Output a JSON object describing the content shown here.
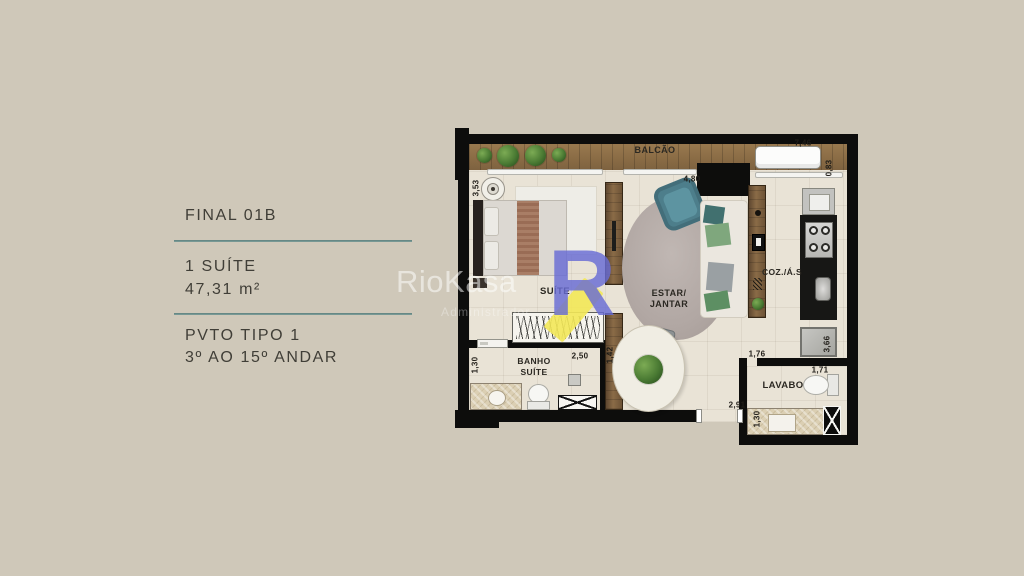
{
  "panel": {
    "title": "FINAL 01B",
    "unit_line1": "1 SUÍTE",
    "unit_line2": "47,31 m²",
    "floor_line1": "PVTO TIPO 1",
    "floor_line2": "3º AO 15º ANDAR"
  },
  "watermark": {
    "brand": "RioKasa",
    "subtitle": "Administrador",
    "logo_letter": "R",
    "logo_color": "#686bd4",
    "logo_accent": "#f3e858"
  },
  "plan": {
    "room_labels": {
      "balcony": "BALCÃO",
      "suite": "SUÍTE",
      "living_line1": "ESTAR/",
      "living_line2": "JANTAR",
      "bathroom_line1": "BANHO",
      "bathroom_line2": "SUÍTE",
      "kitchen": "COZ./Á.S",
      "halfbath": "LAVABO"
    },
    "dimensions": {
      "balcony_width": "7,46",
      "balcony_depth": "0,83",
      "suite_depth": "3,53",
      "living_width": "4,80",
      "bathroom_depth": "1,30",
      "bathroom_width": "2,50",
      "console_length": "1,42",
      "halfbath_top_width": "1,76",
      "halfbath_width": "1,71",
      "living_bottom_width": "2,91",
      "halfbath_sink_depth": "1,30",
      "kitchen_depth": "3,66"
    },
    "colors": {
      "background": "#cfc8b9",
      "floor": "#e9e3d6",
      "wall": "#0d0d0c",
      "wood": "#8a6b45",
      "divider_line": "#6f908d"
    }
  }
}
